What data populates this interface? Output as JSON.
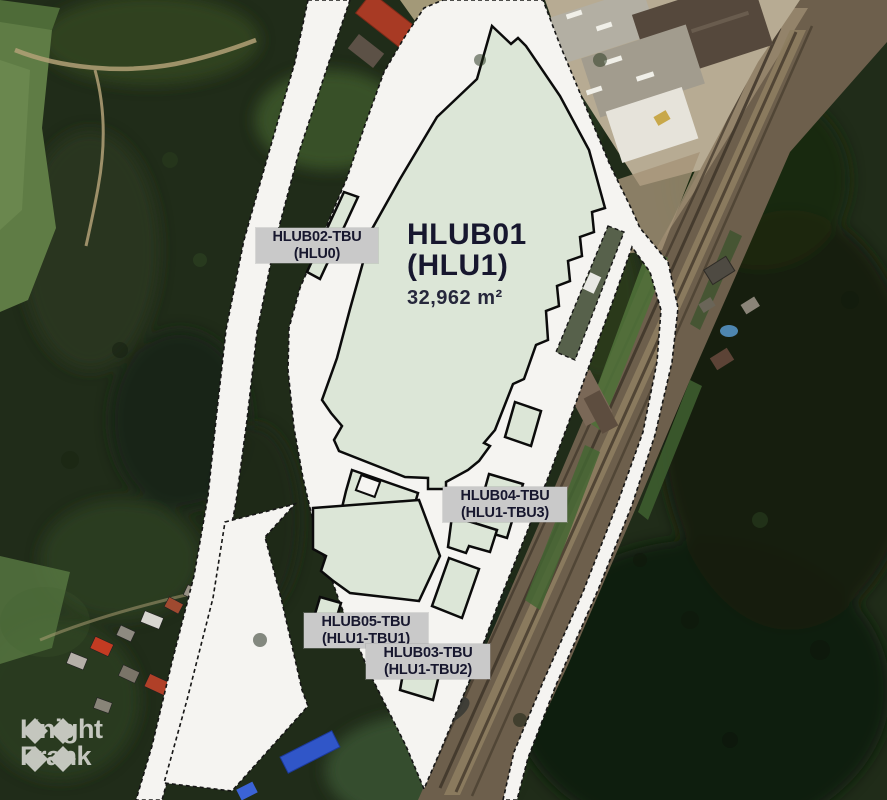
{
  "map": {
    "units": [
      {
        "name": "HLUB01",
        "code": "(HLU1)",
        "area": "32,962 m²"
      },
      {
        "name": "HLUB02-TBU",
        "code": "(HLU0)"
      },
      {
        "name": "HLUB03-TBU",
        "code": "(HLU1-TBU2)"
      },
      {
        "name": "HLUB04-TBU",
        "code": "(HLU1-TBU3)"
      },
      {
        "name": "HLUB05-TBU",
        "code": "(HLU1-TBU1)"
      }
    ],
    "watermark": {
      "line1": "Knight",
      "line2": "Frank"
    }
  },
  "colors": {
    "site_fill": "#f5f4f1",
    "building_fill": "#dce6d7",
    "outline": "#0c0c0c",
    "chip_bg": "#c9c9c9",
    "label_text": "#17172e",
    "forest": "#202c19",
    "watermark": "#f0efec"
  }
}
